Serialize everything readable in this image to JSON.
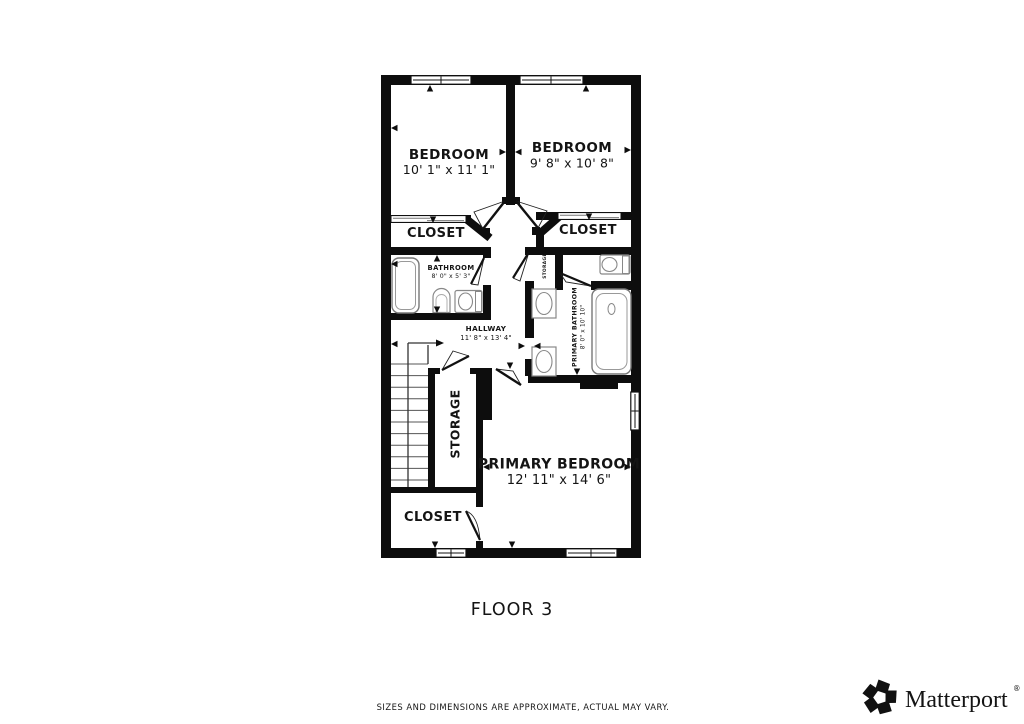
{
  "floor_plan": {
    "floor_label": "FLOOR 3",
    "rooms": {
      "bedroom_left": {
        "name": "BEDROOM",
        "dims": "10' 1\" x 11' 1\""
      },
      "bedroom_right": {
        "name": "BEDROOM",
        "dims": "9' 8\" x 10' 8\""
      },
      "closet_left": {
        "name": "CLOSET"
      },
      "closet_right": {
        "name": "CLOSET"
      },
      "bathroom": {
        "name": "BATHROOM",
        "dims": "8' 0\" x 5' 3\""
      },
      "hallway": {
        "name": "HALLWAY",
        "dims": "11' 8\" x 13' 4\""
      },
      "storage_small": {
        "name": "STORAGE"
      },
      "primary_bathroom": {
        "name": "PRIMARY BATHROOM",
        "dims": "8' 0\" x 10' 10\""
      },
      "storage": {
        "name": "STORAGE"
      },
      "primary_bedroom": {
        "name": "PRIMARY BEDROOM",
        "dims": "12' 11\" x 14' 6\""
      },
      "closet_bottom": {
        "name": "CLOSET"
      }
    }
  },
  "footer": {
    "disclaimer": "SIZES AND DIMENSIONS ARE APPROXIMATE, ACTUAL MAY VARY.",
    "brand": {
      "name": "Matterport",
      "registered": "®"
    }
  },
  "colors": {
    "background": "#ffffff",
    "wall": "#0d0d0d",
    "fixture_outline": "#888888",
    "stair_tread": "#555555",
    "disclaimer_text": "#8e8e8e",
    "brand_text": "#1a1a1a"
  }
}
